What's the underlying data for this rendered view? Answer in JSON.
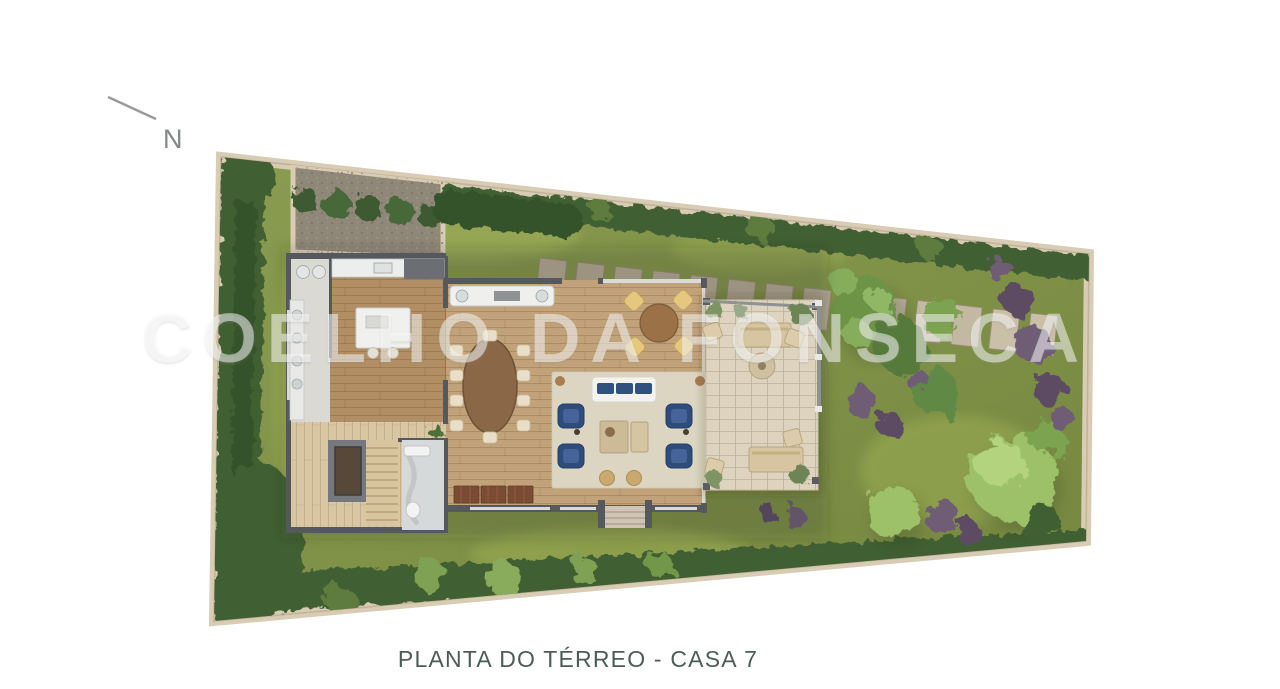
{
  "caption": {
    "text": "PLANTA DO TÉRREO - CASA 7"
  },
  "watermark": {
    "text": "COELHO DA FONSECA",
    "opacity": 0.48,
    "color": "#ffffff"
  },
  "compass": {
    "label": "N"
  },
  "plan": {
    "type": "architectural-floor-plan",
    "floor": "Térreo",
    "unit": "Casa 7",
    "features": [
      "lawn",
      "perimeter-hedges",
      "gravel-courtyard",
      "vine-bed",
      "paver-path",
      "service-corridor",
      "kitchen",
      "kitchen-island",
      "barbecue-counter",
      "dining-table",
      "breakfast-table",
      "living-rug",
      "white-sofa",
      "blue-armchairs",
      "coffee-tables",
      "storage-bench",
      "stairs",
      "elevator",
      "bathroom",
      "entry-steps",
      "wood-deck-patio",
      "outdoor-sofas",
      "pergola-posts",
      "garden-trees",
      "purple-shrubs"
    ]
  },
  "colors": {
    "background": "#ffffff",
    "caption_text": "#4d5c55",
    "compass_text": "#828884",
    "lot_wall": "#d9ccb4",
    "lawn": "#85974b",
    "hedge": "#3f5e33",
    "gravel": "#8f8778",
    "kitchen_floor": "#b18e63",
    "living_floor": "#c1a279",
    "deck_floor": "#d9c7a3",
    "patio_stone": "#ddd3be",
    "house_wall": "#55595d",
    "rug": "#dcd5c2",
    "armchair_navy": "#2e4d7c",
    "dining_table_wood": "#8a6747",
    "tree_light": "#9dc169",
    "tree_mid": "#6d9347",
    "shrub_purple": "#6e5d75",
    "watermark": "#ffffff"
  }
}
